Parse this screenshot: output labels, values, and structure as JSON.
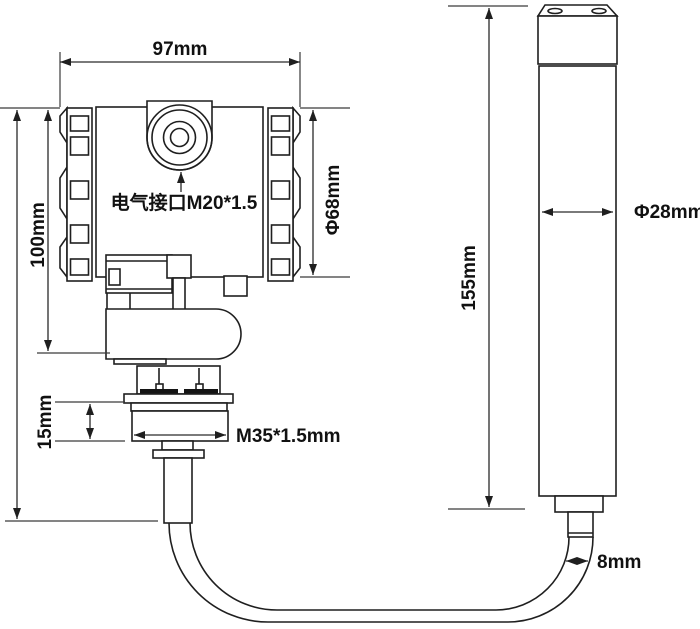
{
  "drawing": {
    "type": "technical-dimension-drawing",
    "subject": "submersible level transmitter with probe",
    "background": "#ffffff",
    "line_color": "#1f1f1f",
    "dimension_color": "#2a2a2a",
    "text_color": "#111111",
    "labels": {
      "top_width": "97mm",
      "housing_height": "100mm",
      "housing_diameter": "Φ68mm",
      "electrical_port": "电气接口M20*1.5",
      "thread_section_height": "15mm",
      "thread_spec": "M35*1.5mm",
      "probe_length": "155mm",
      "probe_diameter": "Φ28mm",
      "cable_diameter": "8mm"
    }
  }
}
